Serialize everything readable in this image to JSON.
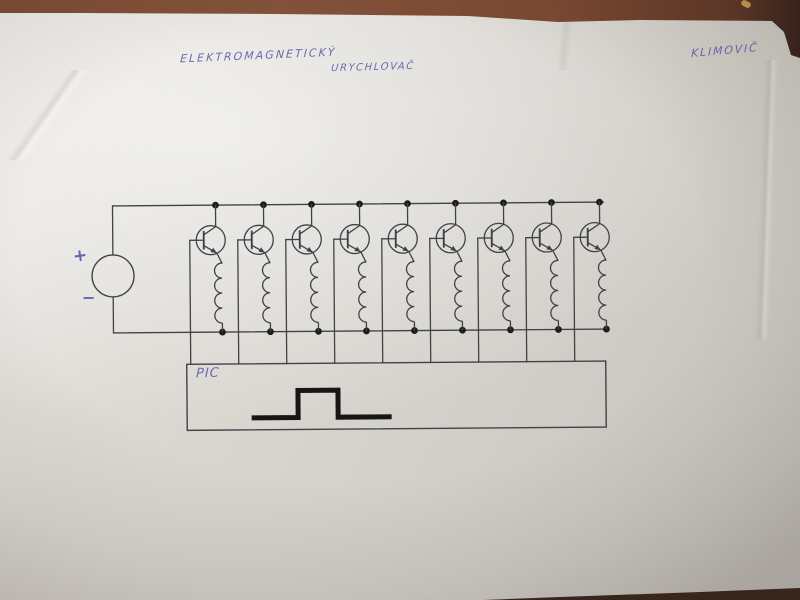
{
  "title": {
    "line1": "ELEKTROMAGNETICKÝ",
    "line2": "URYCHLOVAČ"
  },
  "signature": "KLIMOVIČ",
  "schematic": {
    "stage_count": 9,
    "power_source": {
      "plus_label": "+",
      "minus_label": "−"
    },
    "controller_label": "PIC",
    "pulse_waveform": "single rectangular pulse"
  },
  "colors": {
    "ink": "#5c5caa",
    "wire": "#41414a",
    "dot": "#1d1d1d",
    "pulse": "#161616",
    "table": "#7d4b33",
    "paper": "#d8d5cf"
  }
}
